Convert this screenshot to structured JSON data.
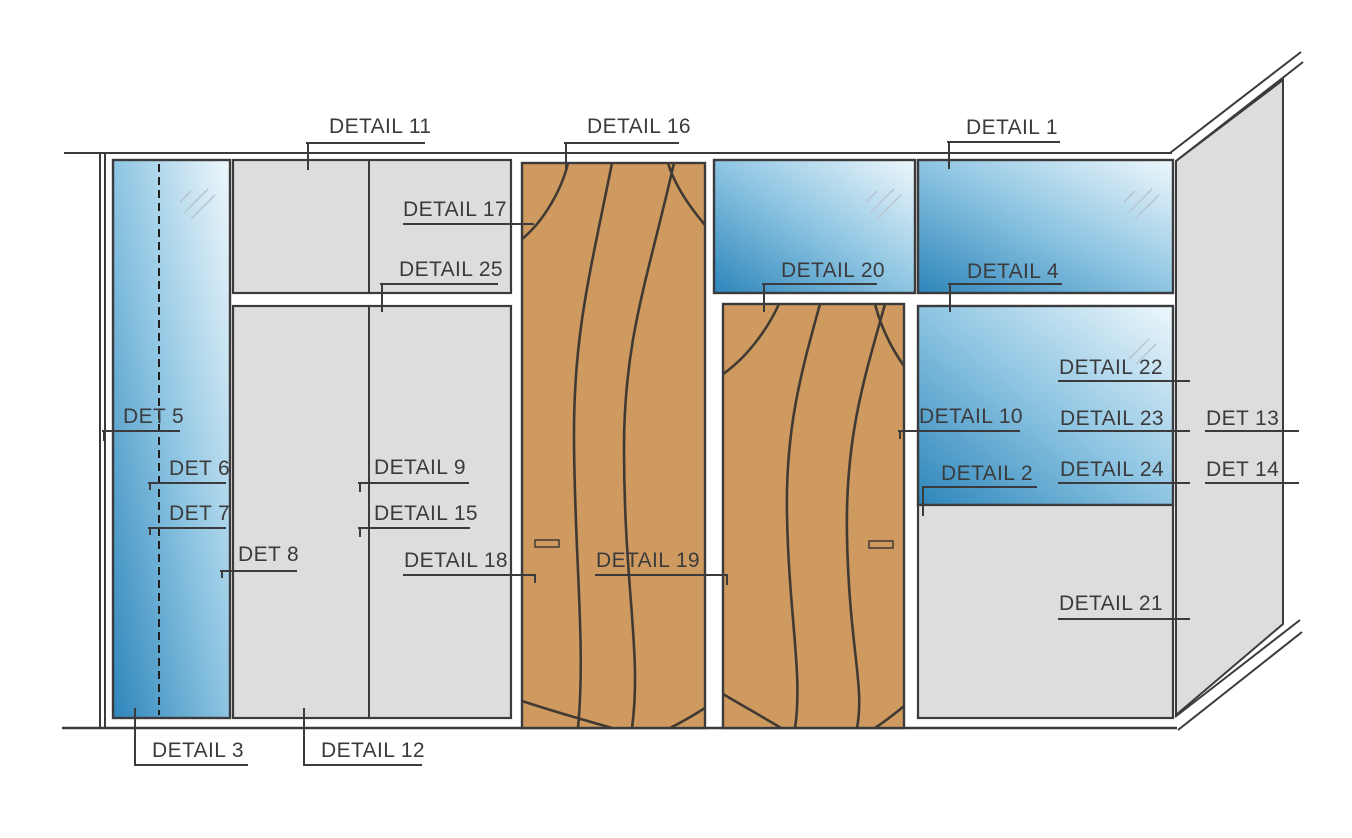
{
  "drawing": {
    "type": "wall-elevation-detail-callout-diagram",
    "colors": {
      "line": "#3b3b3d",
      "text": "#3b3b3d",
      "panel_gray": "#dcdedd",
      "wood": "#cf9a60",
      "grain": "#403a33",
      "glass_dark": "#2e86bb",
      "glass_mid": "#8ec5e2",
      "glass_light": "#eef7fc",
      "shine": "#b9c8d2",
      "background": "#ffffff"
    },
    "labels": [
      {
        "text": "DETAIL 11",
        "tx": 329,
        "ty": 116,
        "segs": [
          [
            306,
            142,
            425,
            142
          ],
          [
            307,
            142,
            307,
            170
          ]
        ]
      },
      {
        "text": "DETAIL 16",
        "tx": 587,
        "ty": 116,
        "segs": [
          [
            564,
            142,
            679,
            142
          ],
          [
            565,
            142,
            565,
            170
          ]
        ]
      },
      {
        "text": "DETAIL 1",
        "tx": 966,
        "ty": 117,
        "segs": [
          [
            947,
            141,
            1060,
            141
          ],
          [
            948,
            141,
            948,
            169
          ]
        ]
      },
      {
        "text": "DETAIL 17",
        "tx": 403,
        "ty": 199,
        "segs": [
          [
            403,
            223,
            534,
            223
          ]
        ]
      },
      {
        "text": "DETAIL 25",
        "tx": 399,
        "ty": 259,
        "segs": [
          [
            380,
            283,
            498,
            283
          ],
          [
            381,
            283,
            381,
            312
          ]
        ]
      },
      {
        "text": "DETAIL 20",
        "tx": 781,
        "ty": 260,
        "segs": [
          [
            762,
            283,
            877,
            283
          ],
          [
            763,
            283,
            763,
            312
          ]
        ]
      },
      {
        "text": "DETAIL 4",
        "tx": 967,
        "ty": 261,
        "segs": [
          [
            948,
            283,
            1062,
            283
          ],
          [
            949,
            283,
            949,
            312
          ]
        ]
      },
      {
        "text": "DETAIL 22",
        "tx": 1059,
        "ty": 357,
        "segs": [
          [
            1058,
            380,
            1190,
            380
          ]
        ]
      },
      {
        "text": "DET 5",
        "tx": 123,
        "ty": 406,
        "segs": [
          [
            102,
            430,
            180,
            430
          ],
          [
            103,
            430,
            103,
            441
          ]
        ]
      },
      {
        "text": "DETAIL 10",
        "tx": 919,
        "ty": 406,
        "segs": [
          [
            898,
            430,
            1020,
            430
          ],
          [
            899,
            430,
            899,
            439
          ]
        ]
      },
      {
        "text": "DETAIL 23",
        "tx": 1060,
        "ty": 408,
        "segs": [
          [
            1058,
            430,
            1190,
            430
          ]
        ]
      },
      {
        "text": "DET 13",
        "tx": 1206,
        "ty": 408,
        "segs": [
          [
            1205,
            430,
            1299,
            430
          ]
        ]
      },
      {
        "text": "DET 6",
        "tx": 169,
        "ty": 458,
        "segs": [
          [
            148,
            482,
            226,
            482
          ],
          [
            149,
            482,
            149,
            490
          ]
        ]
      },
      {
        "text": "DETAIL 9",
        "tx": 374,
        "ty": 457,
        "segs": [
          [
            358,
            482,
            469,
            482
          ],
          [
            359,
            482,
            359,
            492
          ]
        ]
      },
      {
        "text": "DETAIL 24",
        "tx": 1060,
        "ty": 459,
        "segs": [
          [
            1058,
            482,
            1190,
            482
          ]
        ]
      },
      {
        "text": "DET 14",
        "tx": 1206,
        "ty": 459,
        "segs": [
          [
            1205,
            482,
            1299,
            482
          ]
        ]
      },
      {
        "text": "DETAIL 2",
        "tx": 941,
        "ty": 463,
        "segs": [
          [
            922,
            486,
            1037,
            486
          ],
          [
            922,
            486,
            922,
            516
          ]
        ]
      },
      {
        "text": "DET 7",
        "tx": 169,
        "ty": 503,
        "segs": [
          [
            148,
            527,
            226,
            527
          ],
          [
            149,
            527,
            149,
            535
          ]
        ]
      },
      {
        "text": "DETAIL 15",
        "tx": 374,
        "ty": 503,
        "segs": [
          [
            358,
            527,
            470,
            527
          ],
          [
            359,
            527,
            359,
            537
          ]
        ]
      },
      {
        "text": "DET 8",
        "tx": 238,
        "ty": 544,
        "segs": [
          [
            220,
            570,
            297,
            570
          ],
          [
            221,
            570,
            221,
            578
          ]
        ]
      },
      {
        "text": "DETAIL 18",
        "tx": 404,
        "ty": 550,
        "segs": [
          [
            403,
            574,
            535,
            574
          ],
          [
            534,
            574,
            534,
            583
          ]
        ]
      },
      {
        "text": "DETAIL 19",
        "tx": 596,
        "ty": 550,
        "segs": [
          [
            595,
            574,
            727,
            574
          ],
          [
            726,
            574,
            726,
            585
          ]
        ]
      },
      {
        "text": "DETAIL 21",
        "tx": 1059,
        "ty": 593,
        "segs": [
          [
            1058,
            618,
            1190,
            618
          ]
        ]
      },
      {
        "text": "DETAIL 3",
        "tx": 152,
        "ty": 740,
        "segs": [
          [
            134,
            764,
            248,
            764
          ],
          [
            134,
            708,
            134,
            764
          ]
        ]
      },
      {
        "text": "DETAIL 12",
        "tx": 321,
        "ty": 740,
        "segs": [
          [
            303,
            764,
            422,
            764
          ],
          [
            303,
            708,
            303,
            764
          ]
        ]
      }
    ]
  }
}
